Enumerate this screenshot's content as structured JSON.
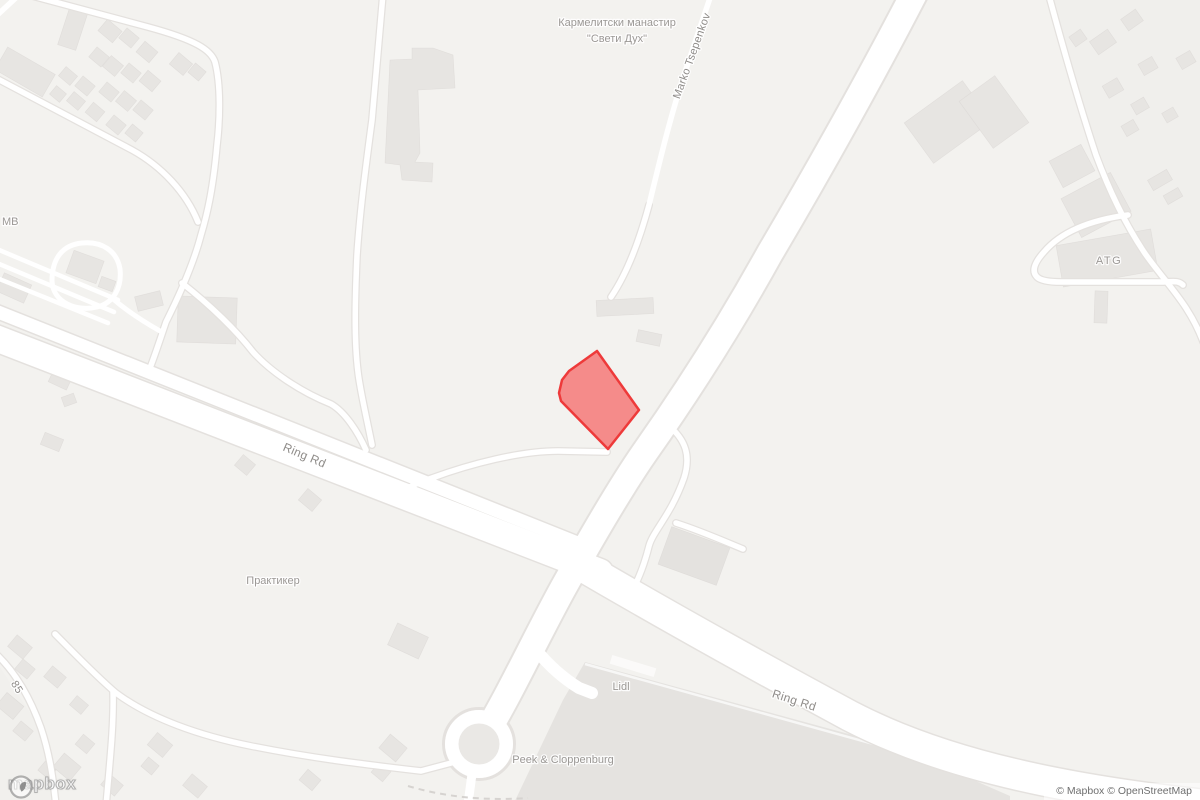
{
  "map": {
    "labels": {
      "monastery_line1": "Кармелитски манастир",
      "monastery_line2": "\"Свети Дух\"",
      "street_marko": "Marko Tsepenkov",
      "road_ring_west": "Ring Rd",
      "road_ring_east": "Ring Rd",
      "poi_praktiker": "Практикер",
      "poi_lidl": "Lidl",
      "poi_peek": "Peek & Cloppenburg",
      "poi_atg": "ATG",
      "poi_mb": "МВ",
      "route_85": "85"
    },
    "highlight": {
      "fill": "#f67f7f",
      "stroke": "#ee3a3a"
    },
    "colors": {
      "background": "#f3f2ef",
      "building": "#e7e5e2",
      "road": "#ffffff",
      "label": "#9b9895"
    },
    "watermark": {
      "logo_text": "mapbox"
    },
    "attribution": {
      "text": "© Mapbox © OpenStreetMap"
    }
  }
}
